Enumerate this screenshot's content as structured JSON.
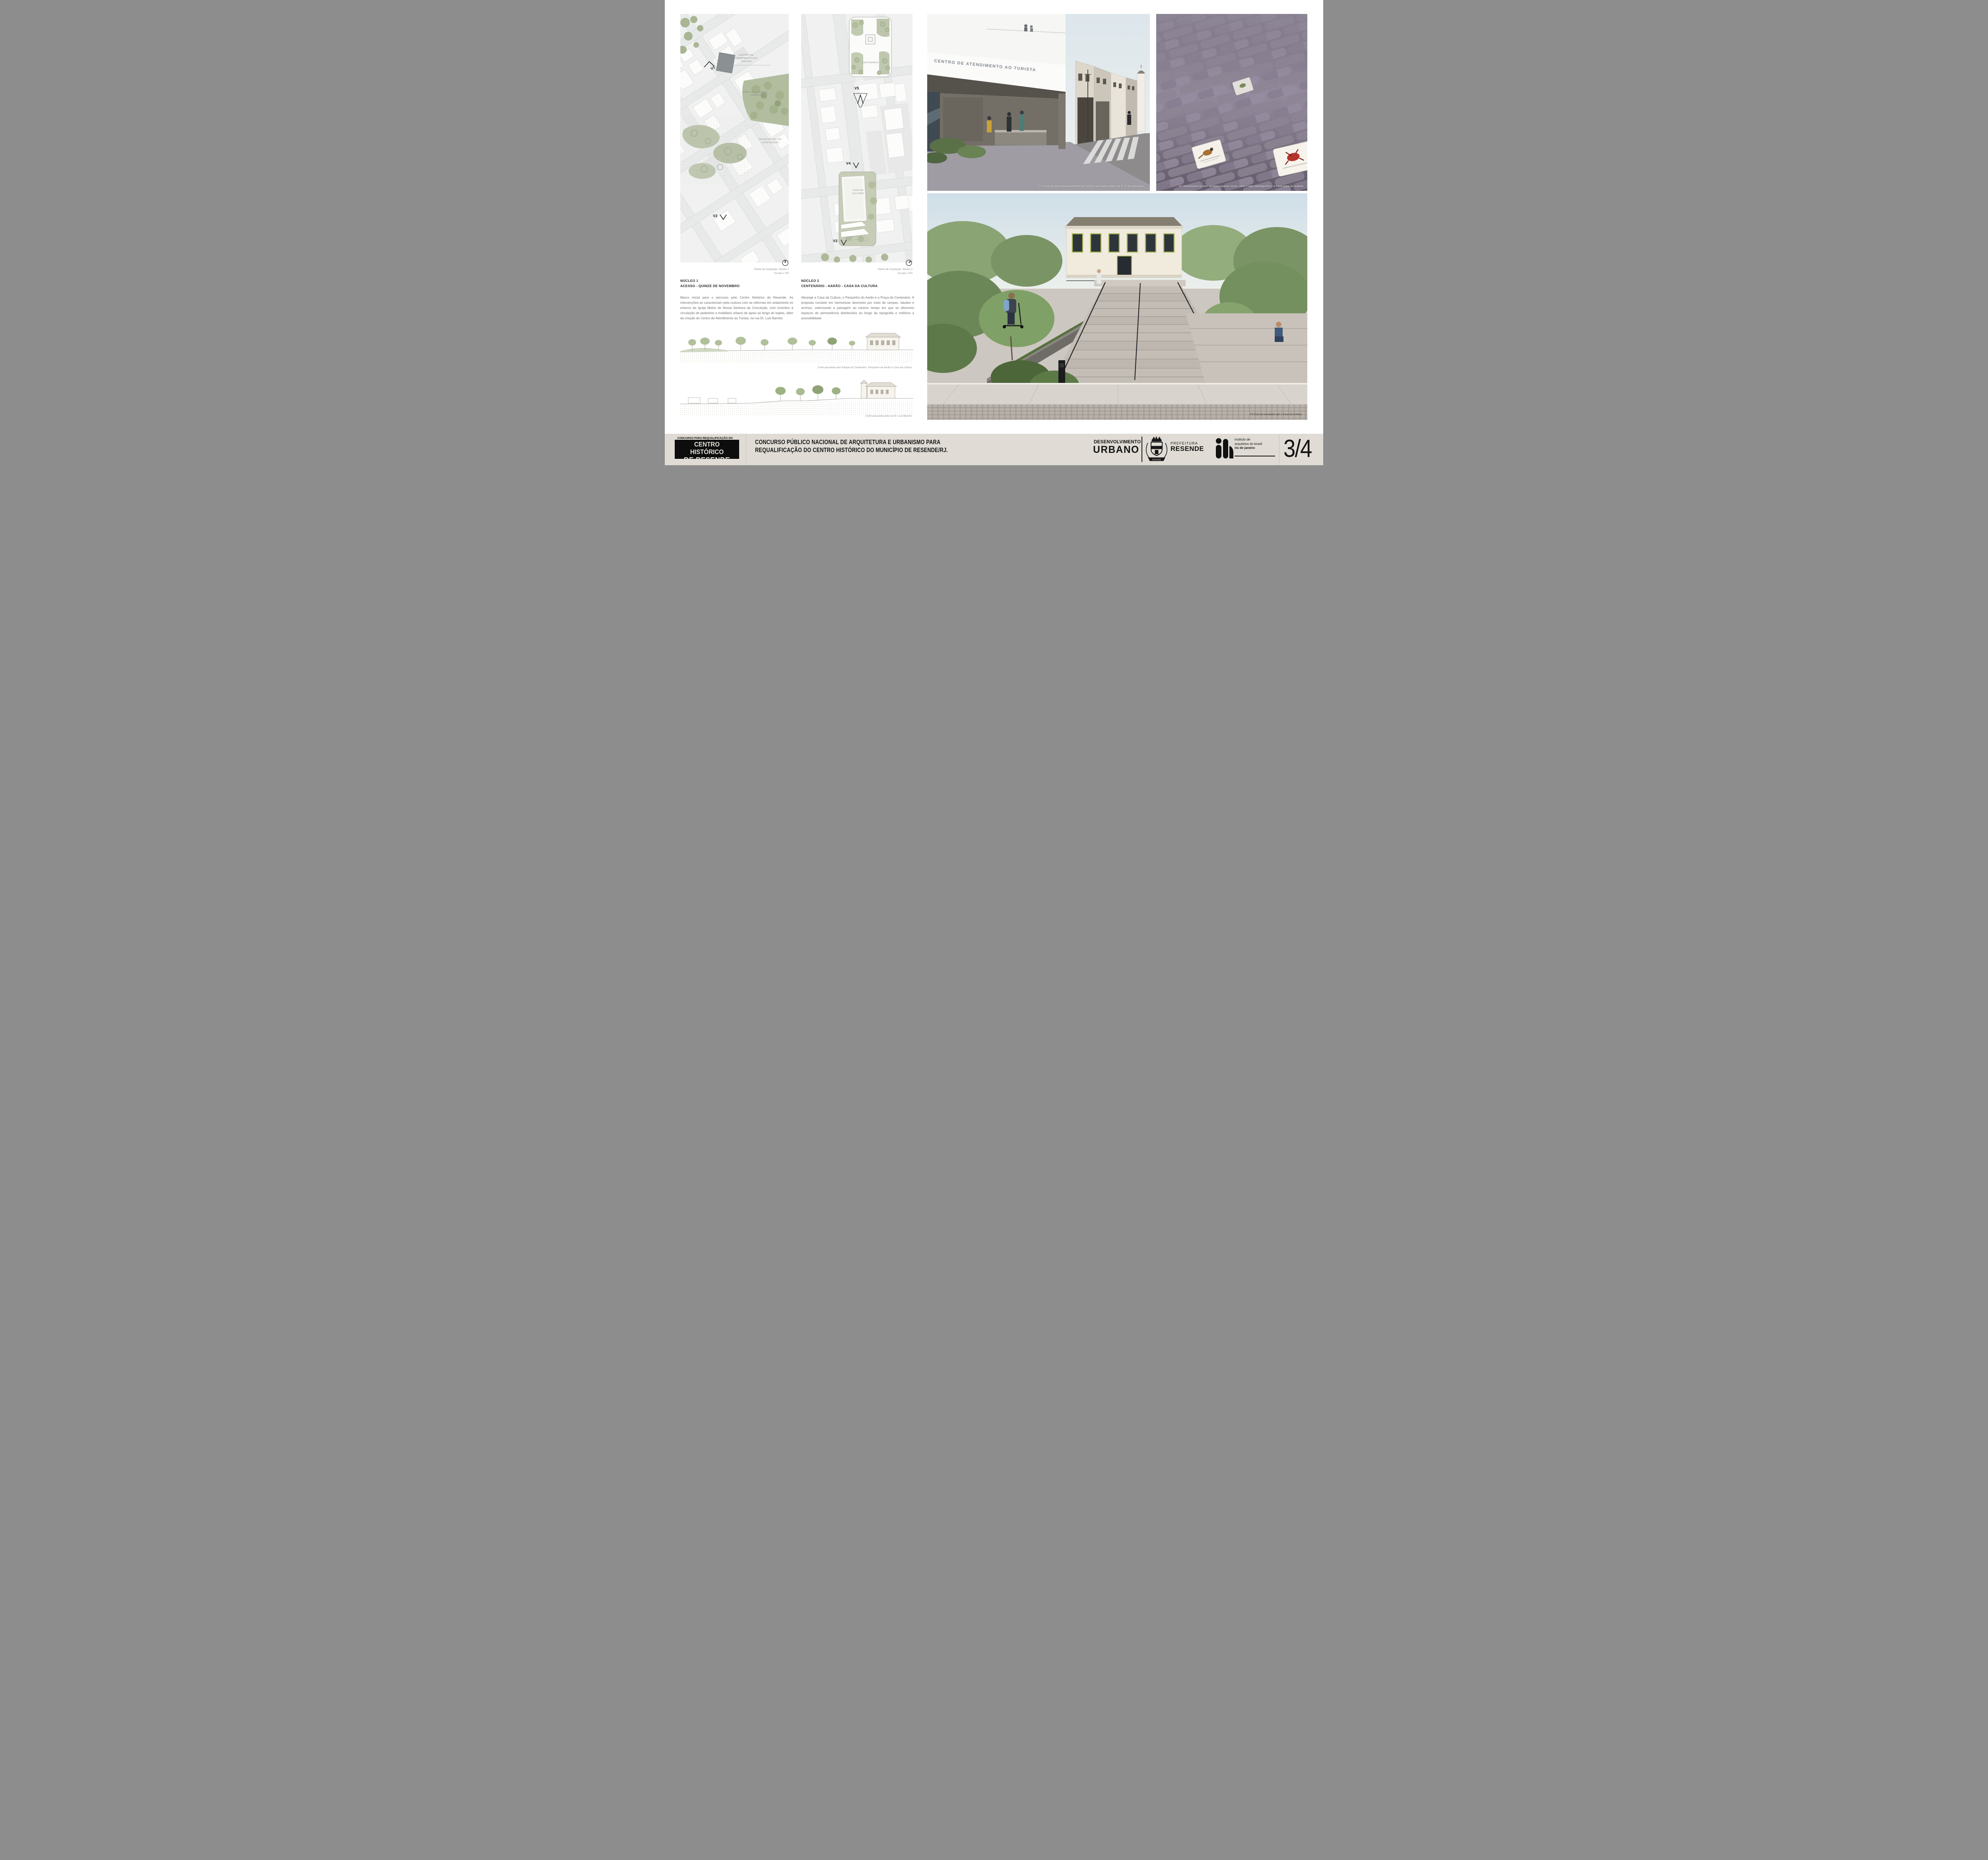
{
  "plan1": {
    "caption": "Planta de Ampliação: Núcleo 1",
    "scale": "Escala 1:750",
    "labels": {
      "centro_atendimento": "CENTRO DE\nATENDIMENTO AO\nTURISTA",
      "area_parque": "ÁREA PARA PARQUE\nURBANO",
      "intervencao": "INTERVENÇÃO EM\nCONSTRUÇÃO",
      "v1": "V1",
      "v2": "V2"
    }
  },
  "plan2": {
    "caption": "Planta de Ampliação: Núcleo 2",
    "scale": "Escala 1:750",
    "labels": {
      "centenario": "CENTENÁRIO",
      "casa_cultura": "CASA DA\nCULTURA",
      "v3": "V3",
      "v4": "V4",
      "v5": "V5"
    }
  },
  "nucleo1": {
    "title": "NÚCLEO 1",
    "subtitle": "ACESSO - QUINZE DE NOVEMBRO",
    "body": "Marco inicial para o percurso pelo Centro Histórico de Resende. As intervenções se caracterizam pela costura com as reformas em andamento no entorno da Igreja Matriz de Nossa Senhora da Conceição, com incentivo à circulação de pedestres e mobiliário urbano de apoio ao longo do trajeto, além da criação do Centro de Atendimento ao Turista, na rua Dr. Luis Barreto."
  },
  "nucleo2": {
    "title": "NÚCLEO 2",
    "subtitle": "CENTENÁRIO - AARÃO - CASA DA CULTURA",
    "body": "Abrange a Casa da Cultura, o Parquinho do Aarão e a Praça do Centenário. A proposta consiste em harmonizar desníveis por meio de rampas, taludes e arrimos, valorizando a paisagem ao mesmo tempo em que se oferecem espaços de permanência distribuídos ao longo da topografia e melhora a acessibilidade."
  },
  "sections": {
    "corte1_caption": "Corte passando pelo Parque do Centenário, Parquinho do Aarão e Casa da Cultura",
    "corte2_caption": "Corte passando pela rua Dr. Luis Barreto"
  },
  "renders": {
    "v1": {
      "signage": "CENTRO DE ATENDIMENTO AO TURISTA",
      "caption": "V1: Vista do Centro de Atendimento ao Turista e ao fundo a Matriz de N. S. da Conceição"
    },
    "v2": {
      "caption": "V2: Intervenções no piso: azulejos espécies locais, como o sapo-flamenguinho e a maria-leque-do-sudeste"
    },
    "v3": {
      "caption": "V3:Vista da escadaria até a Casa da Cultura"
    }
  },
  "footer": {
    "logo_line1": "CONCURSO PARA REQUALIFICAÇÃO DO",
    "logo_line2": "CENTRO HISTÓRICO",
    "logo_line3": "DE RESENDE",
    "title": "CONCURSO PÚBLICO NACIONAL DE ARQUITETURA E URBANISMO PARA\nREQUALIFICAÇÃO DO CENTRO HISTÓRICO DO MUNICÍPIO DE RESENDE/RJ.",
    "desenvolvimento": "DESENVOLVIMENTO",
    "urbano": "URBANO",
    "prefeitura": "PREFEITURA",
    "resende": "RESENDE",
    "crest_banner": "RESENDE",
    "iab_lines": "instituto de\narquitetos do brasil",
    "iab_bold": "rio de janeiro",
    "page_number": "3/4"
  },
  "colors": {
    "footer_bg": "#e0dcd5",
    "map_green": "#b2bc9f",
    "ink": "#141414"
  }
}
